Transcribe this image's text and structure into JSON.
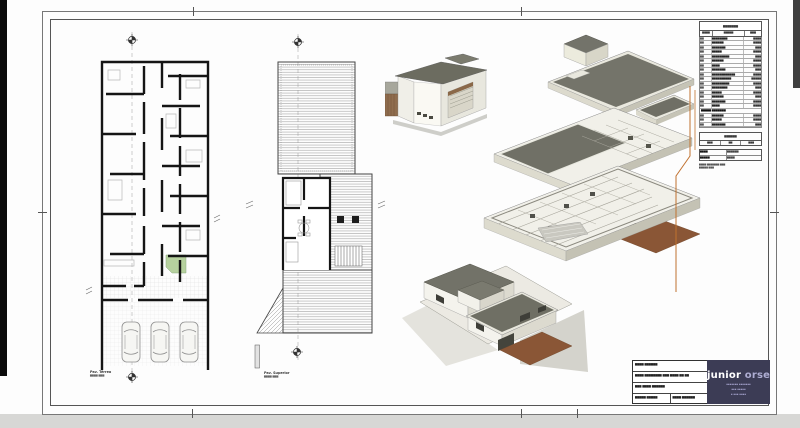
{
  "sheet": {
    "logo": {
      "brand_bold": "junior",
      "brand_light": " orseli",
      "subline1": "▪▪▪▪▪▪▪ ▪▪▪▪▪▪▪",
      "subline2": "▪▪▪ ▪▪▪▪▪",
      "subline3": "▪ ▪▪▪ ▪▪▪▪"
    },
    "title_block": {
      "fields": [
        "▆▆▆▆ ▆▆▆▆▆▆",
        "▆▆▆▆ ▆▆▆▆▆▆▆▆ ▆▆▆ ▆▆▆▆ ▆▆ ▆▆",
        "▆▆▆ ▆▆▆▆ ▆▆▆▆▆▆",
        "▆▆▆▆▆ ▆▆▆▆▆",
        "▆▆▆▆ ▆▆▆▆▆▆"
      ]
    },
    "plans": {
      "ground": {
        "caption_line1": "Pav. Térreo",
        "caption_line2": "▆▆▆▆ ▆▆▆"
      },
      "upper": {
        "caption_line1": "Pav. Superior",
        "caption_line2": "▆▆▆▆ ▆▆▆"
      }
    },
    "schedule": {
      "title": "▆▆▆▆▆▆▆",
      "headers": [
        "▆▆▆▆",
        "▆▆▆▆▆",
        "▆▆▆"
      ],
      "rows": [
        [
          "▆▆",
          "▆▆▆▆▆▆▆▆",
          "▆▆▆▆"
        ],
        [
          "▆▆",
          "▆▆▆▆▆▆",
          "▆▆▆▆"
        ],
        [
          "▆▆",
          "▆▆▆▆▆▆▆",
          "▆▆▆"
        ],
        [
          "▆▆",
          "▆▆▆▆▆",
          "▆▆▆▆"
        ],
        [
          "▆▆",
          "▆▆▆▆▆▆▆▆▆",
          "▆▆▆"
        ],
        [
          "▆▆",
          "▆▆▆▆▆▆",
          "▆▆▆▆"
        ],
        [
          "▆▆",
          "▆▆▆▆",
          "▆▆▆▆"
        ],
        [
          "▆▆",
          "▆▆▆▆▆▆▆",
          "▆▆▆"
        ],
        [
          "▆▆",
          "▆▆▆▆▆▆▆▆▆▆▆▆",
          "▆▆▆▆"
        ],
        [
          "▆▆",
          "▆▆▆▆▆▆▆▆▆▆",
          "▆▆▆▆▆"
        ],
        [
          "▆▆",
          "▆▆▆▆▆▆▆▆▆",
          "▆▆▆▆"
        ],
        [
          "▆▆",
          "▆▆▆▆▆▆▆▆",
          "▆▆▆"
        ],
        [
          "▆▆",
          "▆▆▆▆▆",
          "▆▆▆▆"
        ],
        [
          "▆▆",
          "▆▆▆▆▆▆",
          "▆▆▆"
        ],
        [
          "▆▆",
          "▆▆▆▆▆▆▆",
          "▆▆▆▆"
        ],
        [
          "▆▆",
          "▆▆▆▆",
          "▆▆▆▆"
        ],
        "▆▆▆▆▆ ▆▆▆▆▆▆▆",
        [
          "▆▆",
          "▆▆▆▆▆▆",
          "▆▆▆▆"
        ],
        [
          "▆▆",
          "▆▆▆▆▆",
          "▆▆▆▆"
        ],
        [
          "▆▆",
          "▆▆▆▆▆▆▆",
          "▆▆▆"
        ]
      ],
      "box2": {
        "title": "▆▆▆▆▆▆",
        "headers": [
          "▆▆▆",
          "▆▆",
          "▆▆▆"
        ]
      },
      "summary_rows": [
        [
          "▆▆▆▆",
          "▆▆▆▆▆▆"
        ],
        [
          "▆▆▆▆▆",
          "▆▆▆▆"
        ]
      ],
      "footnote1": "▆▆▆▆ ▆▆▆▆▆▆▆ ▆▆▆",
      "footnote2": "▆▆▆▆▆ ▆▆▆"
    },
    "colors": {
      "roof_olive": "#73736a",
      "wall_white": "#f1f0e9",
      "floor_brown": "#8a5636",
      "leader_orange": "#c0712f",
      "logo_bg": "#3c3c55",
      "landscape_green": "#b6d19e"
    }
  }
}
